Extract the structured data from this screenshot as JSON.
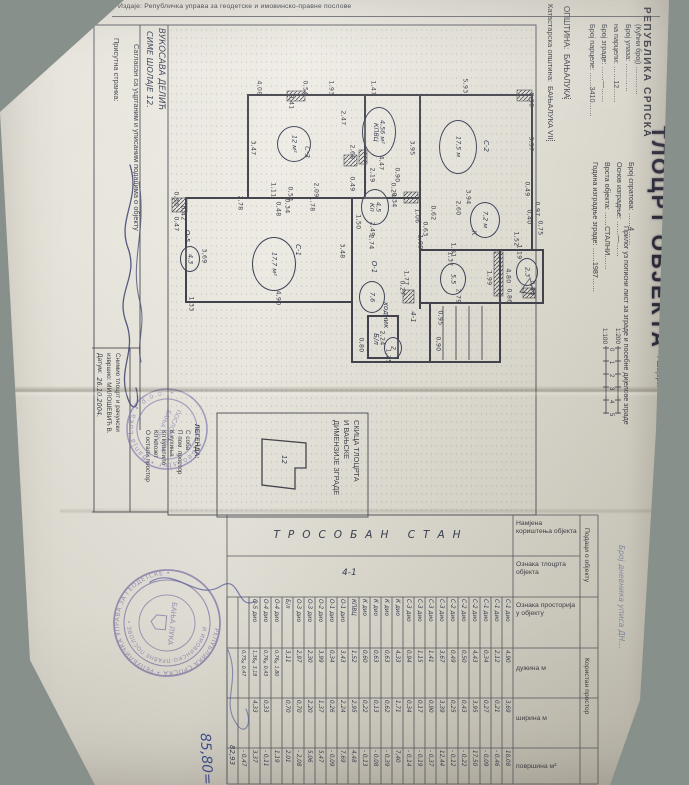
{
  "issuer_line": "Издаје: Републичка управа за геодетске и имовинско-правне послове",
  "big_title": "ТЛОЦРТ ОБЈЕКТА",
  "subtitle": "Прилог уз пописни лист за зграде и посебне дијелове зграде",
  "header": {
    "republic": "РЕПУБЛИКА СРПСКА",
    "municipality_label": "ОПШТИНА:",
    "municipality_value": "БАЊАЛУКА",
    "cadastral_label": "Катастарска општина:",
    "cadastral_value": "БАЊАЛУКА VII"
  },
  "form": {
    "left": [
      {
        "label": "Број парцеле:",
        "value": "3410"
      },
      {
        "label": "Број зграде:",
        "value": "—"
      },
      {
        "label": "на парцели:",
        "value": "12"
      },
      {
        "label": "Број улаза:",
        "value": ""
      },
      {
        "label": "(Кућни број)",
        "value": ""
      }
    ],
    "right": [
      {
        "label": "Година изградње зграде:",
        "value": "1987"
      },
      {
        "label": "Врста објекта:",
        "value": "СТАЛНИ"
      },
      {
        "label": "Основ изградње:",
        "value": "—"
      },
      {
        "label": "Број спратова:",
        "value": "4"
      }
    ]
  },
  "scale": {
    "label": "Размјера:",
    "ratios": [
      "1:100",
      "1:200"
    ],
    "ticks": [
      "0",
      "1",
      "2",
      "3",
      "4",
      "5"
    ]
  },
  "parties": {
    "present_label": "Присутна странка:",
    "agree_text": "Сагласан са уцртаним и уписаним подацима о објекту",
    "owner_name": "ВУКОСАВА ДЕЛИЋ",
    "owner_address": "СИМЕ ШОЛАЈЕ 12.",
    "surveyor_label_1": "Снимио тлоцрт и рачунски",
    "surveyor_label_2": "извршио:  МИЛОШЕВИЋ В.",
    "date_label": "Датум:",
    "date_value": "26.10.2004."
  },
  "plan": {
    "dims": [
      [
        259,
        88,
        "4,08"
      ],
      [
        291,
        102,
        "0,41"
      ],
      [
        305,
        88,
        "0,54"
      ],
      [
        331,
        88,
        "1,93"
      ],
      [
        373,
        88,
        "1,47"
      ],
      [
        465,
        86,
        "5,93"
      ],
      [
        531,
        100,
        "0,50"
      ],
      [
        253,
        148,
        "3,47"
      ],
      [
        343,
        118,
        "2,47"
      ],
      [
        352,
        152,
        "2,68"
      ],
      [
        352,
        184,
        "0,49"
      ],
      [
        358,
        222,
        "1,50"
      ],
      [
        273,
        190,
        "1,11"
      ],
      [
        290,
        194,
        "0,54"
      ],
      [
        316,
        190,
        "2,09"
      ],
      [
        240,
        203,
        "2,78"
      ],
      [
        287,
        206,
        "0,34"
      ],
      [
        312,
        204,
        "1,78"
      ],
      [
        278,
        209,
        "0,48"
      ],
      [
        176,
        199,
        "0,36"
      ],
      [
        183,
        213,
        "0,42"
      ],
      [
        176,
        224,
        "0,47"
      ],
      [
        204,
        256,
        "3,69"
      ],
      [
        342,
        251,
        "3,48"
      ],
      [
        278,
        298,
        "4,90"
      ],
      [
        191,
        304,
        "1,33"
      ],
      [
        412,
        148,
        "3,95"
      ],
      [
        381,
        163,
        "4,47"
      ],
      [
        372,
        175,
        "2,19"
      ],
      [
        397,
        175,
        "0,90"
      ],
      [
        393,
        190,
        "0,24"
      ],
      [
        394,
        200,
        "0,34"
      ],
      [
        417,
        216,
        "1,06"
      ],
      [
        425,
        229,
        "0,63"
      ],
      [
        372,
        229,
        "2,49"
      ],
      [
        371,
        242,
        "2,74"
      ],
      [
        420,
        242,
        "1,09"
      ],
      [
        531,
        144,
        "3,57"
      ],
      [
        468,
        197,
        "3,94"
      ],
      [
        458,
        208,
        "2,60"
      ],
      [
        433,
        213,
        "0,62"
      ],
      [
        527,
        189,
        "0,49"
      ],
      [
        537,
        209,
        "0,97"
      ],
      [
        529,
        217,
        "0,40"
      ],
      [
        540,
        228,
        "0,75"
      ],
      [
        453,
        250,
        "1,81"
      ],
      [
        516,
        239,
        "1,52"
      ],
      [
        519,
        252,
        "1,19"
      ],
      [
        450,
        259,
        "1,37"
      ],
      [
        406,
        278,
        "1,77"
      ],
      [
        489,
        278,
        "1,99"
      ],
      [
        458,
        296,
        "2,79"
      ],
      [
        402,
        288,
        "0,27"
      ],
      [
        508,
        276,
        "4,80"
      ],
      [
        509,
        296,
        "0,86"
      ],
      [
        532,
        288,
        "0,43"
      ],
      [
        440,
        318,
        "0,95"
      ],
      [
        438,
        344,
        "0,90"
      ],
      [
        382,
        338,
        "2,24"
      ],
      [
        388,
        356,
        "1,75"
      ],
      [
        361,
        345,
        "0,80"
      ]
    ],
    "labels": [
      [
        307,
        152,
        "С-3"
      ],
      [
        486,
        146,
        "С-2"
      ],
      [
        298,
        250,
        "С-1"
      ],
      [
        474,
        233,
        "К"
      ],
      [
        374,
        267,
        "О-1"
      ],
      [
        386,
        315,
        "ходник"
      ],
      [
        376,
        339,
        "Б/л"
      ],
      [
        187,
        236,
        "О-5"
      ],
      [
        413,
        317,
        "4-1"
      ]
    ],
    "circles": [
      {
        "x": 293,
        "y": 143,
        "rx": 16,
        "ry": 17,
        "lines": [
          "12 м²"
        ]
      },
      {
        "x": 457,
        "y": 146,
        "rx": 18,
        "ry": 26,
        "lines": [
          "17,5 м"
        ]
      },
      {
        "x": 273,
        "y": 263,
        "rx": 21,
        "ry": 26,
        "lines": [
          "17,7 м²"
        ]
      },
      {
        "x": 378,
        "y": 131,
        "rx": 16,
        "ry": 24,
        "lines": [
          "КПВЦ",
          "4,56 м²"
        ]
      },
      {
        "x": 374,
        "y": 206,
        "rx": 13,
        "ry": 17,
        "lines": [
          "Кп",
          "4,5"
        ]
      },
      {
        "x": 484,
        "y": 219,
        "rx": 14,
        "ry": 17,
        "lines": [
          "7,2 м"
        ]
      },
      {
        "x": 452,
        "y": 278,
        "rx": 12,
        "ry": 15,
        "lines": [
          "5,5"
        ]
      },
      {
        "x": 371,
        "y": 296,
        "rx": 12,
        "ry": 15,
        "lines": [
          "7,6"
        ]
      },
      {
        "x": 526,
        "y": 271,
        "rx": 10,
        "ry": 13,
        "lines": [
          "2,3"
        ]
      },
      {
        "x": 392,
        "y": 347,
        "rx": 8,
        "ry": 10,
        "lines": [
          "2"
        ]
      },
      {
        "x": 189,
        "y": 258,
        "rx": 9,
        "ry": 12,
        "lines": [
          "4,3"
        ]
      }
    ]
  },
  "skica": {
    "title_lines": [
      "СКИЦА ТЛОЦРТА",
      "И ВАЊСКЕ",
      "ДИМЕНЗИЈЕ ЗГРАДЕ"
    ],
    "building_no": "12"
  },
  "legend": {
    "title": "ЛЕГЕНДА:",
    "items": [
      "С  соба",
      "П  пом. простор",
      "К  кухиња",
      "Кп купатило",
      "Кл клозет",
      "О  остали простор"
    ]
  },
  "table": {
    "usage_value": "ТРОСОБАН СТАН",
    "plan_mark": "4-1",
    "headers": [
      "Намјена кориштења објекта",
      "Ознака тлоцрта објекта",
      "Ознака просторија у објекту",
      "дужина м",
      "ширина м",
      "површина м²"
    ],
    "side_labels": [
      "Подаци о објекту",
      "Користан простор"
    ],
    "journal_note": "Број дневника уписа ДН…",
    "rows": [
      [
        "С-1 дио",
        "4,90",
        "3,69",
        "18,08"
      ],
      [
        "С-1 дио",
        "2,12",
        "0,21",
        "- 0,46"
      ],
      [
        "С-1 дио",
        "0,34",
        "0,27",
        "- 0,09"
      ],
      [
        "С-2 дио",
        "4,43",
        "3,95",
        "17,50"
      ],
      [
        "С-2 дио",
        "0,50",
        "0,43",
        "- 0,22"
      ],
      [
        "С-2 дио",
        "0,49",
        "0,25",
        "- 0,12"
      ],
      [
        "С-3 дио",
        "3,67",
        "3,39",
        "12,44"
      ],
      [
        "С-3 дио",
        "1,41",
        "0,90",
        "- 0,37"
      ],
      [
        "С-3 дио",
        "1,15",
        "0,17",
        "- 0,19"
      ],
      [
        "С-3 дио",
        "0,94",
        "0,34",
        "- 0,14"
      ],
      [
        "К дио",
        "4,33",
        "1,71",
        "7,40"
      ],
      [
        "К дио",
        "0,63",
        "0,62",
        "- 0,39"
      ],
      [
        "К дио",
        "0,63",
        "0,13",
        "- 0,08"
      ],
      [
        "К дио",
        "0,60",
        "0,22",
        "- 0,13"
      ],
      [
        "КПВЦ",
        "1,52",
        "2,95",
        "4,48"
      ],
      [
        "О-1 дио",
        "3,43",
        "2,24",
        "7,69"
      ],
      [
        "О-1 дио",
        "0,34",
        "0,26",
        "- 0,09"
      ],
      [
        "О-2 дио",
        "3,99",
        "1,37",
        "5,47"
      ],
      [
        "О-3 дио",
        "2,30",
        "2,20",
        "5,06"
      ],
      [
        "О-3 дио",
        "2,97",
        "0,70",
        "- 2,08"
      ],
      [
        "Б/л",
        "3,11",
        "0,70",
        "2,01"
      ],
      [
        "О-4 дио",
        "0,76×1,80",
        "",
        "1,19"
      ],
      [
        "О-4 дио",
        "0,76×0,43",
        "0,33",
        "- 0,11"
      ],
      [
        "О-5 дио",
        "1,36×3,18",
        "4,33",
        "3,37"
      ],
      [
        "",
        "0,75×0,47",
        "",
        "- 0,47"
      ]
    ],
    "total": "82,93",
    "total_corrected": "85,80="
  },
  "stamps": {
    "geo": {
      "ring": "• GeoAstor • Banja Luka • d.o.o. •",
      "center1": "ПОСЛОВНИЦА",
      "center2": "БАЊА ЛУКА"
    },
    "official": {
      "ring": "РЕПУБЛИКА СРПСКА • РЕПУБЛИЧКА УПРАВА ЗА ГЕОДЕТСКЕ •",
      "ring2": "И ИМОВИНСКО-ПРАВНЕ ПОСЛОВЕ •",
      "center": "БАЊА ЛУКА"
    }
  }
}
